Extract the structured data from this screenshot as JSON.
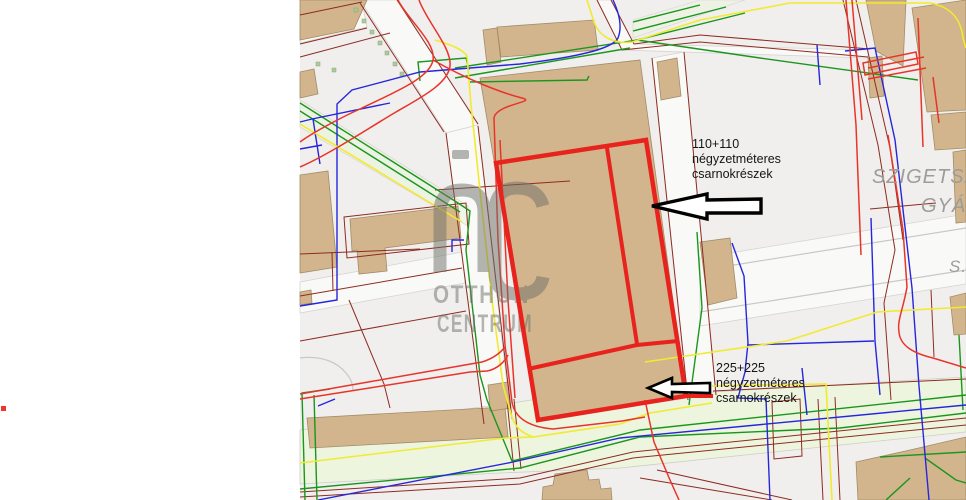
{
  "window": {
    "background": "#ffffff",
    "width": 966,
    "height": 500
  },
  "marker": {
    "color": "#f0342e"
  },
  "map": {
    "background": "#f0efed",
    "palette": {
      "building": "#d2b58c",
      "building_outline": "#a28c68",
      "street": "#f9f9f7",
      "road_strip": "#edf5df",
      "highlight_red": "#e8231d",
      "utility_red": "#e8342a",
      "utility_dark_red": "#8e2b21",
      "utility_green": "#1a961e",
      "utility_blue": "#2626dd",
      "utility_yellow": "#f2ea30",
      "label_gray": "#9c9c99",
      "annotation_text": "#151515"
    },
    "annotations": [
      {
        "id": "halls-110",
        "lines": [
          "110+110",
          "négyzetméteres",
          "csarnokrészek"
        ]
      },
      {
        "id": "halls-225",
        "lines": [
          "225+225",
          "négyzetméteres",
          "csarnokrészek"
        ]
      }
    ],
    "street_labels": [
      {
        "text": "SZIGETSZ"
      },
      {
        "text": "GYÁ"
      },
      {
        "text": "S."
      }
    ],
    "watermark": {
      "brand_initials": "OC",
      "line1": "OTTHON",
      "line2": "CENTRUM"
    }
  }
}
